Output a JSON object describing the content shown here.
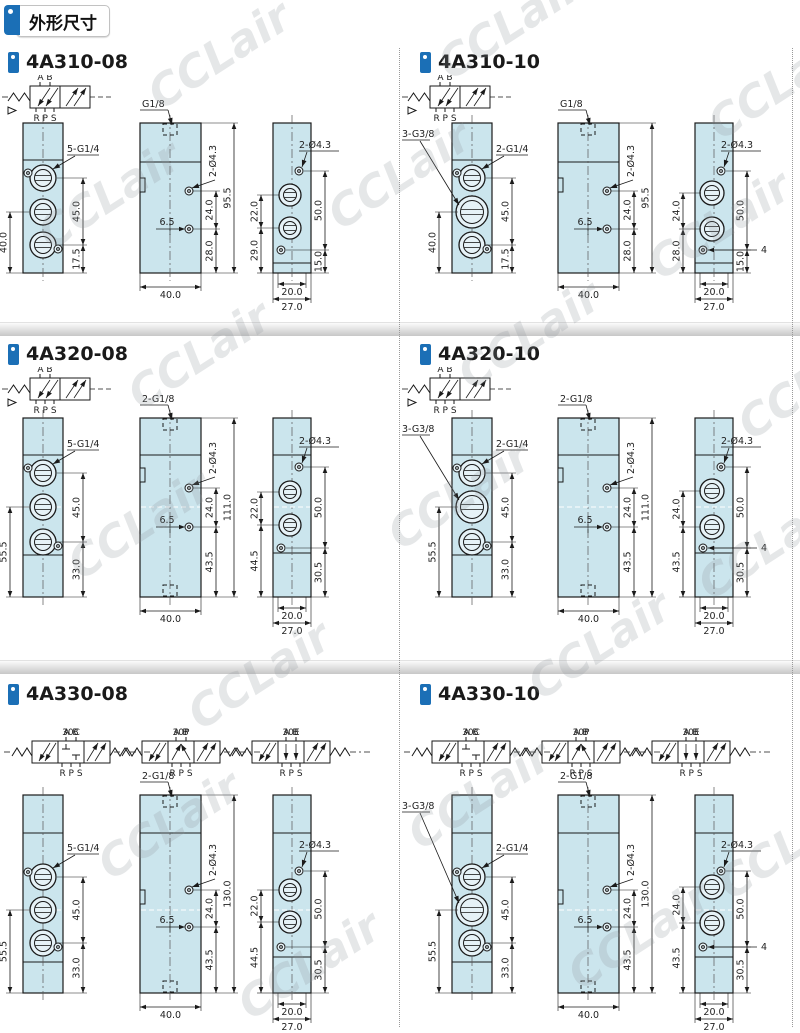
{
  "page": {
    "header_title": "外形尺寸",
    "watermark_text": "CCLair",
    "accent_color": "#1b6fb6",
    "body_fill_color": "#cbe5ed"
  },
  "sections": [
    {
      "model": "4A310-08",
      "series": "310",
      "variant": "08",
      "schematics": [
        {
          "name": "",
          "positions": 2,
          "top_ports": "A B",
          "bottom_ports": "R P S",
          "center_type": ""
        }
      ],
      "front_view": {
        "labels": [
          {
            "text": "5-G1/4",
            "side": "right"
          }
        ],
        "dims": {
          "ports_span": "45.0",
          "below": "17.5",
          "left_span": "40.0"
        }
      },
      "side_view": {
        "top_label": "G1/8",
        "dims": {
          "holes": "2-Ø4.3",
          "screw_gap": "24.0",
          "screw_bottom": "28.0",
          "offset": "6.5",
          "height": "95.5",
          "width": "40.0"
        }
      },
      "end_view": {
        "dims": {
          "holes": "2-Ø4.3",
          "screws_span": "50.0",
          "screw_bottom": "15.0",
          "ports_gap": "22.0",
          "port_bottom": "29.0",
          "width_inner": "20.0",
          "width_outer": "27.0"
        }
      }
    },
    {
      "model": "4A310-10",
      "series": "310",
      "variant": "10",
      "schematics": [
        {
          "name": "",
          "positions": 2,
          "top_ports": "A B",
          "bottom_ports": "R P S",
          "center_type": ""
        }
      ],
      "front_view": {
        "labels": [
          {
            "text": "3-G3/8",
            "side": "left"
          },
          {
            "text": "2-G1/4",
            "side": "right"
          }
        ],
        "dims": {
          "ports_span": "45.0",
          "below": "17.5",
          "left_span": "40.0"
        }
      },
      "side_view": {
        "top_label": "G1/8",
        "dims": {
          "holes": "2-Ø4.3",
          "screw_gap": "24.0",
          "screw_bottom": "28.0",
          "offset": "6.5",
          "height": "95.5",
          "width": "40.0"
        }
      },
      "end_view": {
        "dims": {
          "holes": "2-Ø4.3",
          "screws_span": "50.0",
          "screw_bottom": "15.0",
          "ports_gap": "24.0",
          "port_bottom": "28.0",
          "offset": "4",
          "width_inner": "20.0",
          "width_outer": "27.0"
        }
      }
    },
    {
      "model": "4A320-08",
      "series": "320",
      "variant": "08",
      "schematics": [
        {
          "name": "",
          "positions": 2,
          "top_ports": "A B",
          "bottom_ports": "R P S",
          "center_type": ""
        }
      ],
      "front_view": {
        "labels": [
          {
            "text": "5-G1/4",
            "side": "right"
          }
        ],
        "dims": {
          "ports_span": "45.0",
          "below": "33.0",
          "left_span": "55.5"
        }
      },
      "side_view": {
        "top_label": "2-G1/8",
        "dims": {
          "holes": "2-Ø4.3",
          "screw_gap": "24.0",
          "screw_bottom": "43.5",
          "offset": "6.5",
          "height": "111.0",
          "width": "40.0"
        }
      },
      "end_view": {
        "dims": {
          "holes": "2-Ø4.3",
          "screws_span": "50.0",
          "screw_bottom": "30.5",
          "ports_gap": "22.0",
          "port_bottom": "44.5",
          "width_inner": "20.0",
          "width_outer": "27.0"
        }
      }
    },
    {
      "model": "4A320-10",
      "series": "320",
      "variant": "10",
      "schematics": [
        {
          "name": "",
          "positions": 2,
          "top_ports": "A B",
          "bottom_ports": "R P S",
          "center_type": ""
        }
      ],
      "front_view": {
        "labels": [
          {
            "text": "3-G3/8",
            "side": "left"
          },
          {
            "text": "2-G1/4",
            "side": "right"
          }
        ],
        "dims": {
          "ports_span": "45.0",
          "below": "33.0",
          "left_span": "55.5"
        }
      },
      "side_view": {
        "top_label": "2-G1/8",
        "dims": {
          "holes": "2-Ø4.3",
          "screw_gap": "24.0",
          "screw_bottom": "43.5",
          "offset": "6.5",
          "height": "111.0",
          "width": "40.0"
        }
      },
      "end_view": {
        "dims": {
          "holes": "2-Ø4.3",
          "screws_span": "50.0",
          "screw_bottom": "30.5",
          "ports_gap": "24.0",
          "port_bottom": "43.5",
          "offset": "4",
          "width_inner": "20.0",
          "width_outer": "27.0"
        }
      }
    },
    {
      "model": "4A330-08",
      "series": "330",
      "variant": "08",
      "schematics": [
        {
          "name": "30C",
          "positions": 3,
          "top_ports": "A B",
          "bottom_ports": "R P S",
          "center_type": "closed"
        },
        {
          "name": "30P",
          "positions": 3,
          "top_ports": "A B",
          "bottom_ports": "R P S",
          "center_type": "pressure"
        },
        {
          "name": "30E",
          "positions": 3,
          "top_ports": "A B",
          "bottom_ports": "R P S",
          "center_type": "exhaust"
        }
      ],
      "front_view": {
        "labels": [
          {
            "text": "5-G1/4",
            "side": "right"
          }
        ],
        "dims": {
          "ports_span": "45.0",
          "below": "33.0",
          "left_span": "55.5"
        }
      },
      "side_view": {
        "top_label": "2-G1/8",
        "dims": {
          "holes": "2-Ø4.3",
          "screw_gap": "24.0",
          "screw_bottom": "43.5",
          "offset": "6.5",
          "height": "130.0",
          "width": "40.0"
        }
      },
      "end_view": {
        "dims": {
          "holes": "2-Ø4.3",
          "screws_span": "50.0",
          "screw_bottom": "30.5",
          "ports_gap": "22.0",
          "port_bottom": "44.5",
          "width_inner": "20.0",
          "width_outer": "27.0"
        }
      }
    },
    {
      "model": "4A330-10",
      "series": "330",
      "variant": "10",
      "schematics": [
        {
          "name": "30C",
          "positions": 3,
          "top_ports": "A B",
          "bottom_ports": "R P S",
          "center_type": "closed"
        },
        {
          "name": "30P",
          "positions": 3,
          "top_ports": "A B",
          "bottom_ports": "R P S",
          "center_type": "pressure"
        },
        {
          "name": "30E",
          "positions": 3,
          "top_ports": "A B",
          "bottom_ports": "R P S",
          "center_type": "exhaust"
        }
      ],
      "front_view": {
        "labels": [
          {
            "text": "2-G1/4",
            "side": "right"
          },
          {
            "text": "3-G3/8",
            "side": "left"
          }
        ],
        "dims": {
          "ports_span": "45.0",
          "below": "33.0",
          "left_span": "55.5"
        }
      },
      "side_view": {
        "top_label": "2-G1/8",
        "dims": {
          "holes": "2-Ø4.3",
          "screw_gap": "24.0",
          "screw_bottom": "43.5",
          "offset": "6.5",
          "height": "130.0",
          "width": "40.0"
        }
      },
      "end_view": {
        "dims": {
          "holes": "2-Ø4.3",
          "screws_span": "50.0",
          "screw_bottom": "30.5",
          "ports_gap": "24.0",
          "port_bottom": "43.5",
          "offset": "4",
          "width_inner": "20.0",
          "width_outer": "27.0"
        }
      }
    }
  ]
}
